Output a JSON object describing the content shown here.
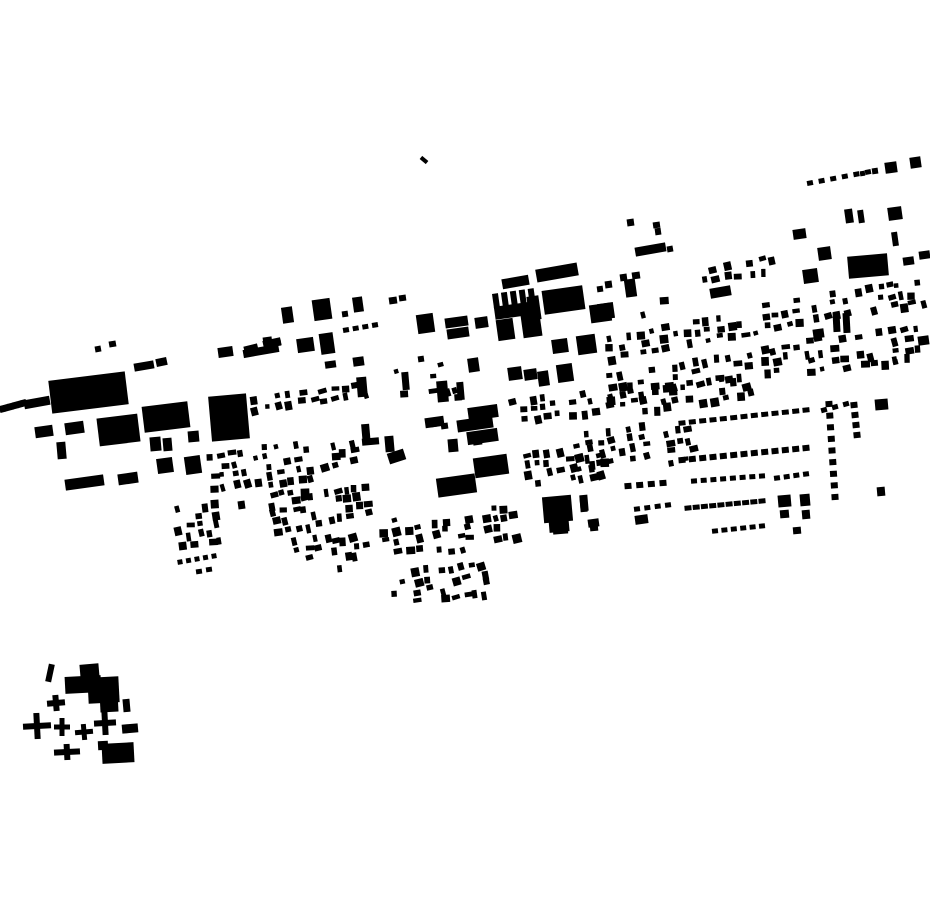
{
  "meta": {
    "background_color": "#ffffff",
    "ink_color": "#000000",
    "canvas_width": 930,
    "canvas_height": 924
  },
  "map": {
    "rects": [
      [
        24,
        398,
        26,
        9,
        -10
      ],
      [
        50,
        376,
        77,
        33,
        -7
      ],
      [
        95,
        346,
        6,
        6,
        -10
      ],
      [
        109,
        341,
        7,
        6,
        -10
      ],
      [
        134,
        362,
        20,
        8,
        -10
      ],
      [
        156,
        358,
        11,
        8,
        -12
      ],
      [
        35,
        426,
        18,
        11,
        -8
      ],
      [
        65,
        422,
        19,
        12,
        -8
      ],
      [
        98,
        416,
        41,
        28,
        -7
      ],
      [
        143,
        404,
        46,
        26,
        -7
      ],
      [
        210,
        395,
        38,
        45,
        -5
      ],
      [
        57,
        442,
        9,
        17,
        -5
      ],
      [
        150,
        437,
        11,
        14,
        -5
      ],
      [
        163,
        438,
        9,
        13,
        -5
      ],
      [
        188,
        431,
        11,
        11,
        -5
      ],
      [
        65,
        477,
        39,
        11,
        -8
      ],
      [
        118,
        473,
        20,
        11,
        -8
      ],
      [
        157,
        458,
        16,
        15,
        -8
      ],
      [
        185,
        456,
        16,
        18,
        -8
      ],
      [
        218,
        347,
        15,
        10,
        -8
      ],
      [
        244,
        345,
        14,
        7,
        -14
      ],
      [
        263,
        339,
        18,
        8,
        -12
      ],
      [
        420,
        158,
        8,
        4,
        40
      ],
      [
        282,
        307,
        11,
        16,
        -8
      ],
      [
        313,
        299,
        18,
        21,
        -8
      ],
      [
        353,
        297,
        10,
        15,
        -8
      ],
      [
        389,
        297,
        8,
        7,
        -8
      ],
      [
        399,
        295,
        7,
        6,
        -8
      ],
      [
        342,
        311,
        6,
        6,
        -8
      ],
      [
        417,
        314,
        17,
        19,
        -8
      ],
      [
        445,
        317,
        23,
        10,
        -8
      ],
      [
        447,
        328,
        22,
        10,
        -8
      ],
      [
        475,
        317,
        13,
        11,
        -8
      ],
      [
        528,
        296,
        12,
        24,
        -8
      ],
      [
        627,
        219,
        7,
        7,
        -8
      ],
      [
        653,
        222,
        7,
        6,
        -8
      ],
      [
        655,
        228,
        6,
        7,
        -8
      ],
      [
        635,
        245,
        31,
        9,
        -10
      ],
      [
        667,
        246,
        6,
        6,
        -10
      ],
      [
        620,
        274,
        7,
        7,
        -8
      ],
      [
        632,
        272,
        8,
        7,
        -8
      ],
      [
        357,
        377,
        10,
        20,
        -5
      ],
      [
        402,
        372,
        7,
        18,
        -5
      ],
      [
        437,
        381,
        11,
        21,
        -5
      ],
      [
        457,
        382,
        7,
        18,
        -5
      ],
      [
        325,
        361,
        11,
        7,
        -8
      ],
      [
        353,
        357,
        11,
        9,
        -8
      ],
      [
        418,
        356,
        6,
        6,
        -8
      ],
      [
        468,
        358,
        11,
        14,
        -8
      ],
      [
        297,
        338,
        17,
        14,
        -8
      ],
      [
        320,
        333,
        14,
        21,
        -8
      ],
      [
        263,
        337,
        9,
        7,
        -8
      ],
      [
        274,
        340,
        7,
        6,
        -8
      ],
      [
        243,
        347,
        36,
        8,
        -10
      ],
      [
        238,
        501,
        7,
        8,
        -8
      ],
      [
        362,
        424,
        8,
        21,
        -5
      ],
      [
        362,
        438,
        17,
        7,
        -5
      ],
      [
        385,
        436,
        9,
        16,
        -5
      ],
      [
        388,
        451,
        17,
        11,
        -18
      ],
      [
        425,
        417,
        19,
        10,
        -8
      ],
      [
        448,
        439,
        10,
        13,
        -5
      ],
      [
        468,
        406,
        30,
        13,
        -8
      ],
      [
        457,
        418,
        36,
        12,
        -8
      ],
      [
        467,
        430,
        31,
        13,
        -8
      ],
      [
        474,
        456,
        34,
        20,
        -8
      ],
      [
        437,
        476,
        39,
        19,
        -8
      ],
      [
        543,
        496,
        29,
        26,
        -5
      ],
      [
        549,
        518,
        20,
        14,
        -5
      ],
      [
        580,
        496,
        7,
        16,
        -5
      ],
      [
        590,
        524,
        8,
        7,
        -5
      ],
      [
        502,
        277,
        27,
        10,
        -10
      ],
      [
        536,
        266,
        42,
        13,
        -10
      ],
      [
        543,
        288,
        41,
        24,
        -8
      ],
      [
        522,
        314,
        19,
        23,
        -8
      ],
      [
        497,
        319,
        17,
        21,
        -8
      ],
      [
        552,
        339,
        16,
        14,
        -8
      ],
      [
        577,
        335,
        19,
        19,
        -8
      ],
      [
        590,
        304,
        21,
        18,
        -8
      ],
      [
        597,
        286,
        6,
        6,
        -8
      ],
      [
        605,
        281,
        7,
        7,
        -8
      ],
      [
        625,
        279,
        11,
        18,
        -8
      ],
      [
        598,
        303,
        16,
        16,
        -8
      ],
      [
        508,
        367,
        14,
        13,
        -8
      ],
      [
        524,
        369,
        13,
        11,
        -8
      ],
      [
        538,
        371,
        11,
        15,
        -8
      ],
      [
        557,
        364,
        16,
        18,
        -8
      ],
      [
        793,
        229,
        13,
        10,
        -8
      ],
      [
        818,
        247,
        13,
        13,
        -8
      ],
      [
        848,
        255,
        40,
        22,
        -5
      ],
      [
        803,
        269,
        15,
        14,
        -8
      ],
      [
        892,
        232,
        6,
        14,
        -8
      ],
      [
        903,
        257,
        11,
        8,
        -8
      ],
      [
        919,
        251,
        11,
        8,
        -8
      ],
      [
        845,
        209,
        8,
        14,
        -8
      ],
      [
        858,
        210,
        6,
        13,
        -8
      ],
      [
        888,
        207,
        14,
        13,
        -8
      ],
      [
        872,
        168,
        6,
        6,
        -8
      ],
      [
        885,
        162,
        12,
        11,
        -8
      ],
      [
        910,
        157,
        11,
        11,
        -8
      ],
      [
        860,
        171,
        5,
        5,
        -8
      ],
      [
        710,
        287,
        21,
        10,
        -10
      ],
      [
        833,
        312,
        7,
        20,
        -3
      ],
      [
        843,
        313,
        7,
        20,
        -3
      ],
      [
        813,
        329,
        11,
        9,
        -8
      ],
      [
        918,
        336,
        11,
        9,
        -8
      ],
      [
        875,
        399,
        13,
        11,
        -5
      ],
      [
        877,
        487,
        8,
        9,
        -5
      ],
      [
        588,
        519,
        11,
        8,
        -8
      ],
      [
        635,
        515,
        13,
        9,
        -8
      ],
      [
        580,
        495,
        8,
        16,
        -5
      ],
      [
        778,
        495,
        13,
        12,
        -5
      ],
      [
        780,
        510,
        9,
        8,
        -5
      ],
      [
        800,
        494,
        10,
        12,
        -5
      ],
      [
        802,
        510,
        8,
        9,
        -5
      ],
      [
        793,
        527,
        8,
        7,
        -5
      ],
      [
        430,
        420,
        8,
        7,
        -8
      ],
      [
        441,
        423,
        7,
        6,
        -8
      ],
      [
        473,
        438,
        9,
        7,
        -8
      ],
      [
        553,
        528,
        15,
        6,
        -5
      ],
      [
        196,
        569,
        6,
        5,
        -8
      ],
      [
        206,
        567,
        6,
        5,
        -8
      ],
      [
        47,
        664,
        6,
        18,
        12
      ],
      [
        80,
        664,
        19,
        14,
        -5
      ],
      [
        65,
        676,
        36,
        17,
        -3
      ],
      [
        88,
        677,
        31,
        26,
        -3
      ],
      [
        100,
        692,
        18,
        20,
        -3
      ],
      [
        123,
        699,
        7,
        13,
        -5
      ],
      [
        122,
        724,
        16,
        9,
        -5
      ],
      [
        102,
        743,
        32,
        20,
        -3
      ],
      [
        98,
        741,
        10,
        9,
        -3
      ]
    ],
    "comb": {
      "x": 492,
      "y": 294,
      "n": 5,
      "tw": 6,
      "gap": 3,
      "th": 15,
      "base_h": 13,
      "rot": -8
    },
    "dash_lines": [
      {
        "x1": 2,
        "y1": 409,
        "x2": 24,
        "y2": 403,
        "n": 6,
        "w": 5,
        "h": 7
      },
      {
        "x1": 346,
        "y1": 330,
        "x2": 375,
        "y2": 325,
        "n": 4,
        "w": 6,
        "h": 5
      },
      {
        "x1": 810,
        "y1": 183,
        "x2": 868,
        "y2": 172,
        "n": 6,
        "w": 6,
        "h": 5
      },
      {
        "x1": 682,
        "y1": 423,
        "x2": 806,
        "y2": 410,
        "n": 13,
        "w": 7,
        "h": 5
      },
      {
        "x1": 682,
        "y1": 460,
        "x2": 806,
        "y2": 448,
        "n": 13,
        "w": 7,
        "h": 6
      },
      {
        "x1": 694,
        "y1": 481,
        "x2": 762,
        "y2": 476,
        "n": 8,
        "w": 6,
        "h": 5
      },
      {
        "x1": 777,
        "y1": 478,
        "x2": 806,
        "y2": 474,
        "n": 4,
        "w": 6,
        "h": 5
      },
      {
        "x1": 688,
        "y1": 508,
        "x2": 762,
        "y2": 501,
        "n": 10,
        "w": 7,
        "h": 5
      },
      {
        "x1": 715,
        "y1": 531,
        "x2": 762,
        "y2": 526,
        "n": 6,
        "w": 6,
        "h": 5
      },
      {
        "x1": 829,
        "y1": 404,
        "x2": 835,
        "y2": 497,
        "n": 9,
        "w": 6,
        "h": 7
      },
      {
        "x1": 854,
        "y1": 405,
        "x2": 857,
        "y2": 435,
        "n": 4,
        "w": 6,
        "h": 7
      },
      {
        "x1": 824,
        "y1": 410,
        "x2": 846,
        "y2": 404,
        "n": 3,
        "w": 6,
        "h": 5
      },
      {
        "x1": 637,
        "y1": 509,
        "x2": 668,
        "y2": 505,
        "n": 4,
        "w": 6,
        "h": 5
      },
      {
        "x1": 628,
        "y1": 486,
        "x2": 663,
        "y2": 483,
        "n": 4,
        "w": 7,
        "h": 6
      },
      {
        "x1": 180,
        "y1": 562,
        "x2": 214,
        "y2": 556,
        "n": 5,
        "w": 5,
        "h": 5
      }
    ],
    "crosses": [
      {
        "x": 56,
        "y": 703,
        "ax": 9,
        "ay": 8,
        "t": 6,
        "rot": -5
      },
      {
        "x": 37,
        "y": 726,
        "ax": 14,
        "ay": 13,
        "t": 6,
        "rot": -3
      },
      {
        "x": 62,
        "y": 727,
        "ax": 8,
        "ay": 9,
        "t": 5,
        "rot": 0
      },
      {
        "x": 84,
        "y": 732,
        "ax": 9,
        "ay": 8,
        "t": 5,
        "rot": -5
      },
      {
        "x": 105,
        "y": 723,
        "ax": 11,
        "ay": 12,
        "t": 6,
        "rot": -3
      },
      {
        "x": 67,
        "y": 752,
        "ax": 13,
        "ay": 8,
        "t": 6,
        "rot": -3
      }
    ],
    "clusters": [
      {
        "x": 207,
        "y": 455,
        "cols": 5,
        "rows": 4,
        "seed": 21
      },
      {
        "x": 263,
        "y": 445,
        "cols": 5,
        "rows": 5,
        "dx": 10,
        "dy": 9,
        "seed": 22
      },
      {
        "x": 319,
        "y": 443,
        "cols": 4,
        "rows": 4,
        "dx": 10,
        "seed": 23
      },
      {
        "x": 173,
        "y": 507,
        "cols": 5,
        "rows": 5,
        "dx": 10,
        "dy": 9,
        "seed": 24
      },
      {
        "x": 269,
        "y": 492,
        "cols": 5,
        "rows": 5,
        "dx": 10,
        "dy": 9,
        "seed": 25
      },
      {
        "x": 323,
        "y": 489,
        "cols": 5,
        "rows": 4,
        "dx": 10,
        "dy": 9,
        "seed": 26
      },
      {
        "x": 294,
        "y": 539,
        "cols": 4,
        "rows": 3,
        "dx": 10,
        "dy": 9,
        "seed": 27
      },
      {
        "x": 331,
        "y": 537,
        "cols": 4,
        "rows": 4,
        "dx": 10,
        "dy": 9,
        "seed": 28
      },
      {
        "x": 250,
        "y": 396,
        "cols": 6,
        "rows": 2,
        "dx": 12,
        "dy": 11,
        "seed": 11
      },
      {
        "x": 320,
        "y": 388,
        "cols": 5,
        "rows": 2,
        "seed": 12
      },
      {
        "x": 395,
        "y": 371,
        "cols": 6,
        "rows": 3,
        "gap": 0.45,
        "seed": 13
      },
      {
        "x": 605,
        "y": 335,
        "cols": 5,
        "rows": 3,
        "seed": 31
      },
      {
        "x": 660,
        "y": 325,
        "cols": 5,
        "rows": 3,
        "seed": 32
      },
      {
        "x": 715,
        "y": 315,
        "cols": 4,
        "rows": 3,
        "seed": 33
      },
      {
        "x": 605,
        "y": 375,
        "cols": 5,
        "rows": 3,
        "seed": 34
      },
      {
        "x": 660,
        "y": 365,
        "cols": 5,
        "rows": 3,
        "seed": 35
      },
      {
        "x": 712,
        "y": 356,
        "cols": 4,
        "rows": 3,
        "seed": 36
      },
      {
        "x": 760,
        "y": 305,
        "cols": 4,
        "rows": 3,
        "seed": 37
      },
      {
        "x": 760,
        "y": 348,
        "cols": 4,
        "rows": 3,
        "seed": 38
      },
      {
        "x": 808,
        "y": 295,
        "cols": 4,
        "rows": 3,
        "seed": 39
      },
      {
        "x": 805,
        "y": 340,
        "cols": 4,
        "rows": 4,
        "seed": 40
      },
      {
        "x": 855,
        "y": 288,
        "cols": 4,
        "rows": 3,
        "seed": 41
      },
      {
        "x": 855,
        "y": 333,
        "cols": 4,
        "rows": 4,
        "seed": 42
      },
      {
        "x": 895,
        "y": 283,
        "cols": 3,
        "rows": 3,
        "seed": 43
      },
      {
        "x": 890,
        "y": 328,
        "cols": 3,
        "rows": 4,
        "seed": 44
      },
      {
        "x": 640,
        "y": 300,
        "cols": 4,
        "rows": 2,
        "seed": 45
      },
      {
        "x": 700,
        "y": 267,
        "cols": 4,
        "rows": 2,
        "seed": 46
      },
      {
        "x": 748,
        "y": 260,
        "cols": 3,
        "rows": 2,
        "seed": 47
      },
      {
        "x": 584,
        "y": 432,
        "cols": 6,
        "rows": 4,
        "seed": 48
      },
      {
        "x": 663,
        "y": 430,
        "cols": 3,
        "rows": 4,
        "seed": 49
      },
      {
        "x": 430,
        "y": 390,
        "cols": 3,
        "rows": 2,
        "gap": 0.3,
        "seed": 68
      },
      {
        "x": 700,
        "y": 398,
        "cols": 5,
        "rows": 1,
        "dx": 12,
        "gap": 0.2,
        "seed": 69
      },
      {
        "x": 606,
        "y": 392,
        "cols": 6,
        "rows": 3,
        "seed": 73
      },
      {
        "x": 660,
        "y": 388,
        "cols": 3,
        "rows": 3,
        "seed": 74
      },
      {
        "x": 705,
        "y": 380,
        "cols": 6,
        "rows": 2,
        "dx": 12,
        "seed": 75
      },
      {
        "x": 522,
        "y": 452,
        "cols": 5,
        "rows": 4,
        "seed": 61
      },
      {
        "x": 575,
        "y": 445,
        "cols": 3,
        "rows": 4,
        "dx": 10,
        "seed": 62
      },
      {
        "x": 380,
        "y": 519,
        "cols": 4,
        "rows": 4,
        "seed": 63
      },
      {
        "x": 432,
        "y": 519,
        "cols": 4,
        "rows": 4,
        "seed": 64
      },
      {
        "x": 480,
        "y": 507,
        "cols": 4,
        "rows": 4,
        "dx": 10,
        "seed": 65
      },
      {
        "x": 389,
        "y": 572,
        "cols": 4,
        "rows": 4,
        "seed": 66
      },
      {
        "x": 439,
        "y": 567,
        "cols": 5,
        "rows": 4,
        "dx": 10,
        "seed": 67
      },
      {
        "x": 510,
        "y": 398,
        "cols": 5,
        "rows": 3,
        "dx": 10,
        "seed": 71
      },
      {
        "x": 568,
        "y": 391,
        "cols": 3,
        "rows": 3,
        "dx": 10,
        "seed": 72
      }
    ]
  }
}
